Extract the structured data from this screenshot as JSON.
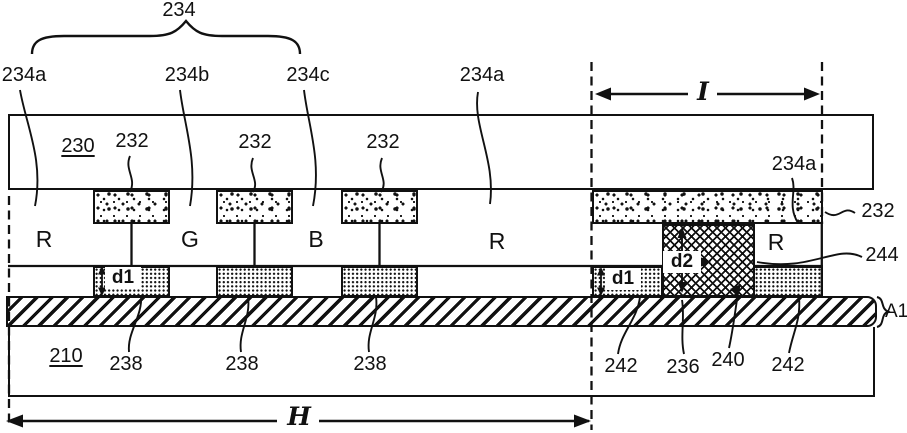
{
  "figure_type": "patent-cross-section-diagram",
  "colors": {
    "ink": "#111111",
    "paper": "#ffffff"
  },
  "labels": {
    "group_234": "234",
    "cf_234a_topleft": "234a",
    "cf_234b": "234b",
    "cf_234c": "234c",
    "cf_234a_topcenter": "234a",
    "cf_234a_right": "234a",
    "substrate_upper_230": "230",
    "cf_232_1": "232",
    "cf_232_2": "232",
    "cf_232_3": "232",
    "cf_232_right": "232",
    "region_r1": "R",
    "region_g": "G",
    "region_b": "B",
    "region_r2": "R",
    "region_r3": "R",
    "layer_244": "244",
    "gap_d1_left": "d1",
    "gap_d1_right": "d1",
    "gap_d2": "d2",
    "line_a1": "A1",
    "substrate_lower_210": "210",
    "spacer_238_1": "238",
    "spacer_238_2": "238",
    "spacer_238_3": "238",
    "part_242_left": "242",
    "part_236": "236",
    "part_240": "240",
    "part_242_right": "242",
    "dim_h": "H",
    "dim_i": "I"
  }
}
